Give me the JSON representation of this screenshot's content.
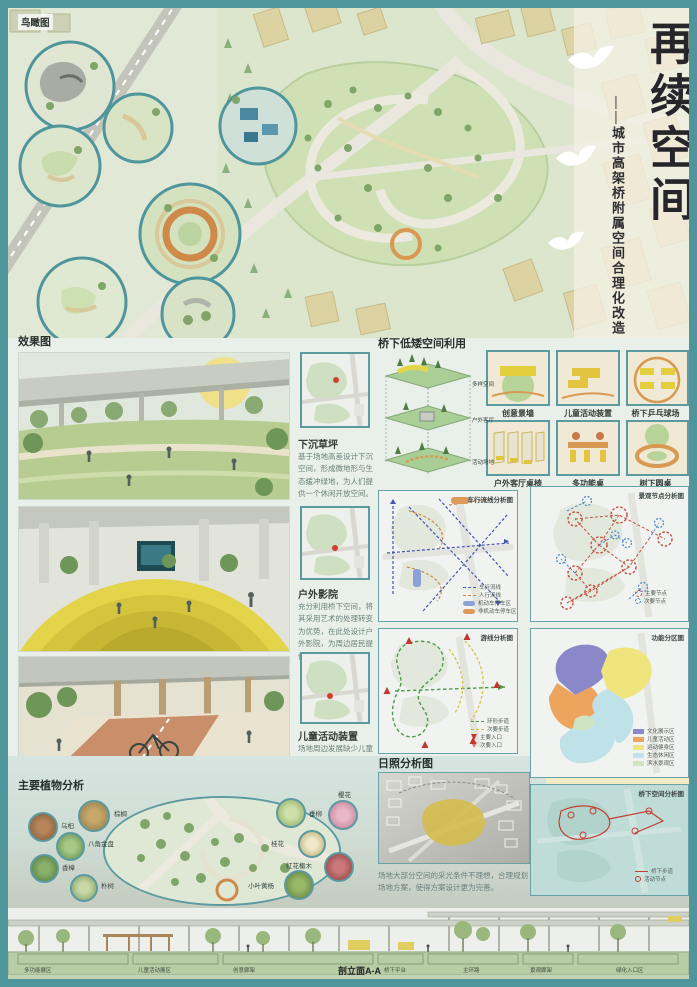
{
  "colors": {
    "accent_teal": "#4f959c",
    "sun_circle": "#f5ecc6",
    "zone_purple": "#8a88c8",
    "zone_orange": "#eda45c",
    "zone_yellow": "#efe57e",
    "zone_cyan": "#c2e2e8",
    "zone_green": "#cfe5c2"
  },
  "header": {
    "aerial_label": "鸟瞰图",
    "title": "再续空间",
    "subtitle": "——城市高架桥附属空间合理化改造"
  },
  "renders": {
    "section_label": "效果图",
    "items": [
      {
        "title": "下沉草坪",
        "desc": "基于场地高差设计下沉空间，形成微地形与生态缓冲绿地，为人们提供一个休闲开放空间。"
      },
      {
        "title": "户外影院",
        "desc": "充分利用桥下空间，将其采用艺术的处理转变为优势，在此处设计户外影院，为周边居民提供一个休闲娱乐场所。"
      },
      {
        "title": "儿童活动装置",
        "desc": "场地周边发展缺少儿童活动场地，所以在此处设计儿童活动装置。"
      }
    ]
  },
  "under_bridge": {
    "section_label": "桥下低矮空间利用",
    "layers": [
      "多样空间",
      "户外客厅",
      "活动场地"
    ],
    "items": [
      "创意景墙",
      "儿童活动装置",
      "桥下乒乓球场",
      "户外客厅桌椅",
      "多功能桌",
      "树下圆桌"
    ]
  },
  "maps": [
    {
      "title": "车行流线分析图",
      "legend": [
        "车行流线",
        "人行流线",
        "机动车停车区",
        "非机动车停车区"
      ]
    },
    {
      "title": "景观节点分析图",
      "legend": [
        "主要节点",
        "次要节点"
      ]
    },
    {
      "title": "游线分析图",
      "legend": [
        "环形步道",
        "次要步道",
        "主要入口",
        "次要入口"
      ]
    },
    {
      "title": "功能分区图",
      "legend": [
        "文化展示区",
        "儿童活动区",
        "运动健身区",
        "生态休闲区",
        "滨水景观区"
      ]
    },
    {
      "title": "桥下空间分析图",
      "legend": [
        "桥下步道",
        "活动节点"
      ]
    }
  ],
  "sunlight": {
    "section_label": "日照分析图",
    "desc": "场地大部分空间的采光条件不理想，合理规划场地方案，使得方案设计更为完善。"
  },
  "plants": {
    "section_label": "主要植物分析",
    "left": [
      "棕榈",
      "乌桕",
      "八角金盘",
      "香樟",
      "朴树"
    ],
    "right": [
      "垂柳",
      "樱花",
      "桂花",
      "红花檵木",
      "小叶黄杨"
    ]
  },
  "elevation": {
    "label": "剖立面A-A",
    "segments": [
      "多功能展区",
      "儿童活动展区",
      "创意廊架",
      "桥下平台",
      "主环路",
      "景观廊架",
      "绿化入口区"
    ]
  }
}
